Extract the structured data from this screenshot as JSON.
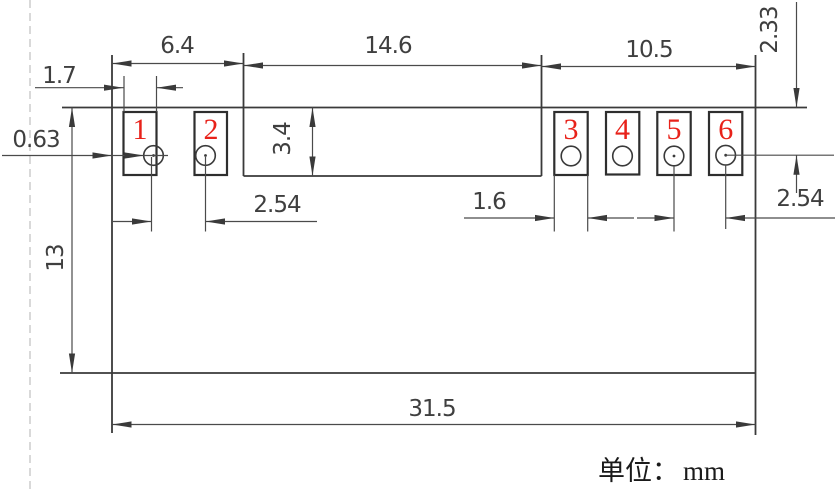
{
  "unit": {
    "cn": "单位：",
    "mm": "mm"
  },
  "dims": {
    "left_group_width": "6.4",
    "middle_width": "14.6",
    "right_group_width": "10.5",
    "left_pad_width": "1.7",
    "edge_to_hole": "0.63",
    "notch_height": "3.4",
    "body_height": "13",
    "top_to_hole_center": "2.33",
    "left_pitch": "2.54",
    "right_pad_width": "1.6",
    "right_pitch": "2.54",
    "total_width": "31.5"
  },
  "pins": [
    {
      "number": "1"
    },
    {
      "number": "2"
    },
    {
      "number": "3"
    },
    {
      "number": "4"
    },
    {
      "number": "5"
    },
    {
      "number": "6"
    }
  ],
  "colors": {
    "pin_number_red": "#e8221a",
    "line_dark": "#3a3a3a",
    "dashed_gray": "#b3b3b3",
    "background": "#ffffff"
  }
}
